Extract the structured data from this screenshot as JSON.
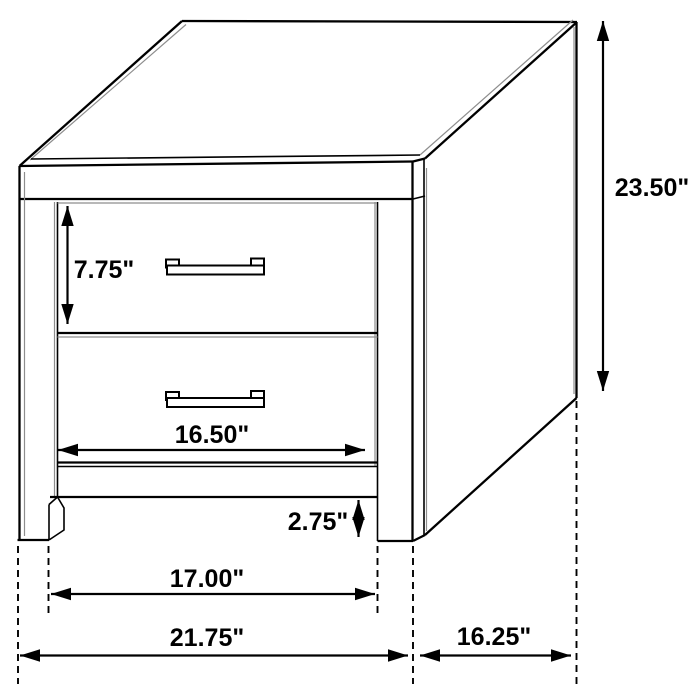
{
  "figure": {
    "kind": "furniture-dimension-diagram",
    "subject": "two-drawer nightstand line drawing with dimension callouts"
  },
  "dimensions": {
    "overall_height": "23.50\"",
    "drawer_height": "7.75\"",
    "drawer_width": "16.50\"",
    "base_height": "2.75\"",
    "leg_span": "17.00\"",
    "overall_width": "21.75\"",
    "depth": "16.25\""
  },
  "colors": {
    "line": "#000000",
    "secondary_line": "#8d8d8d",
    "background": "#ffffff"
  }
}
